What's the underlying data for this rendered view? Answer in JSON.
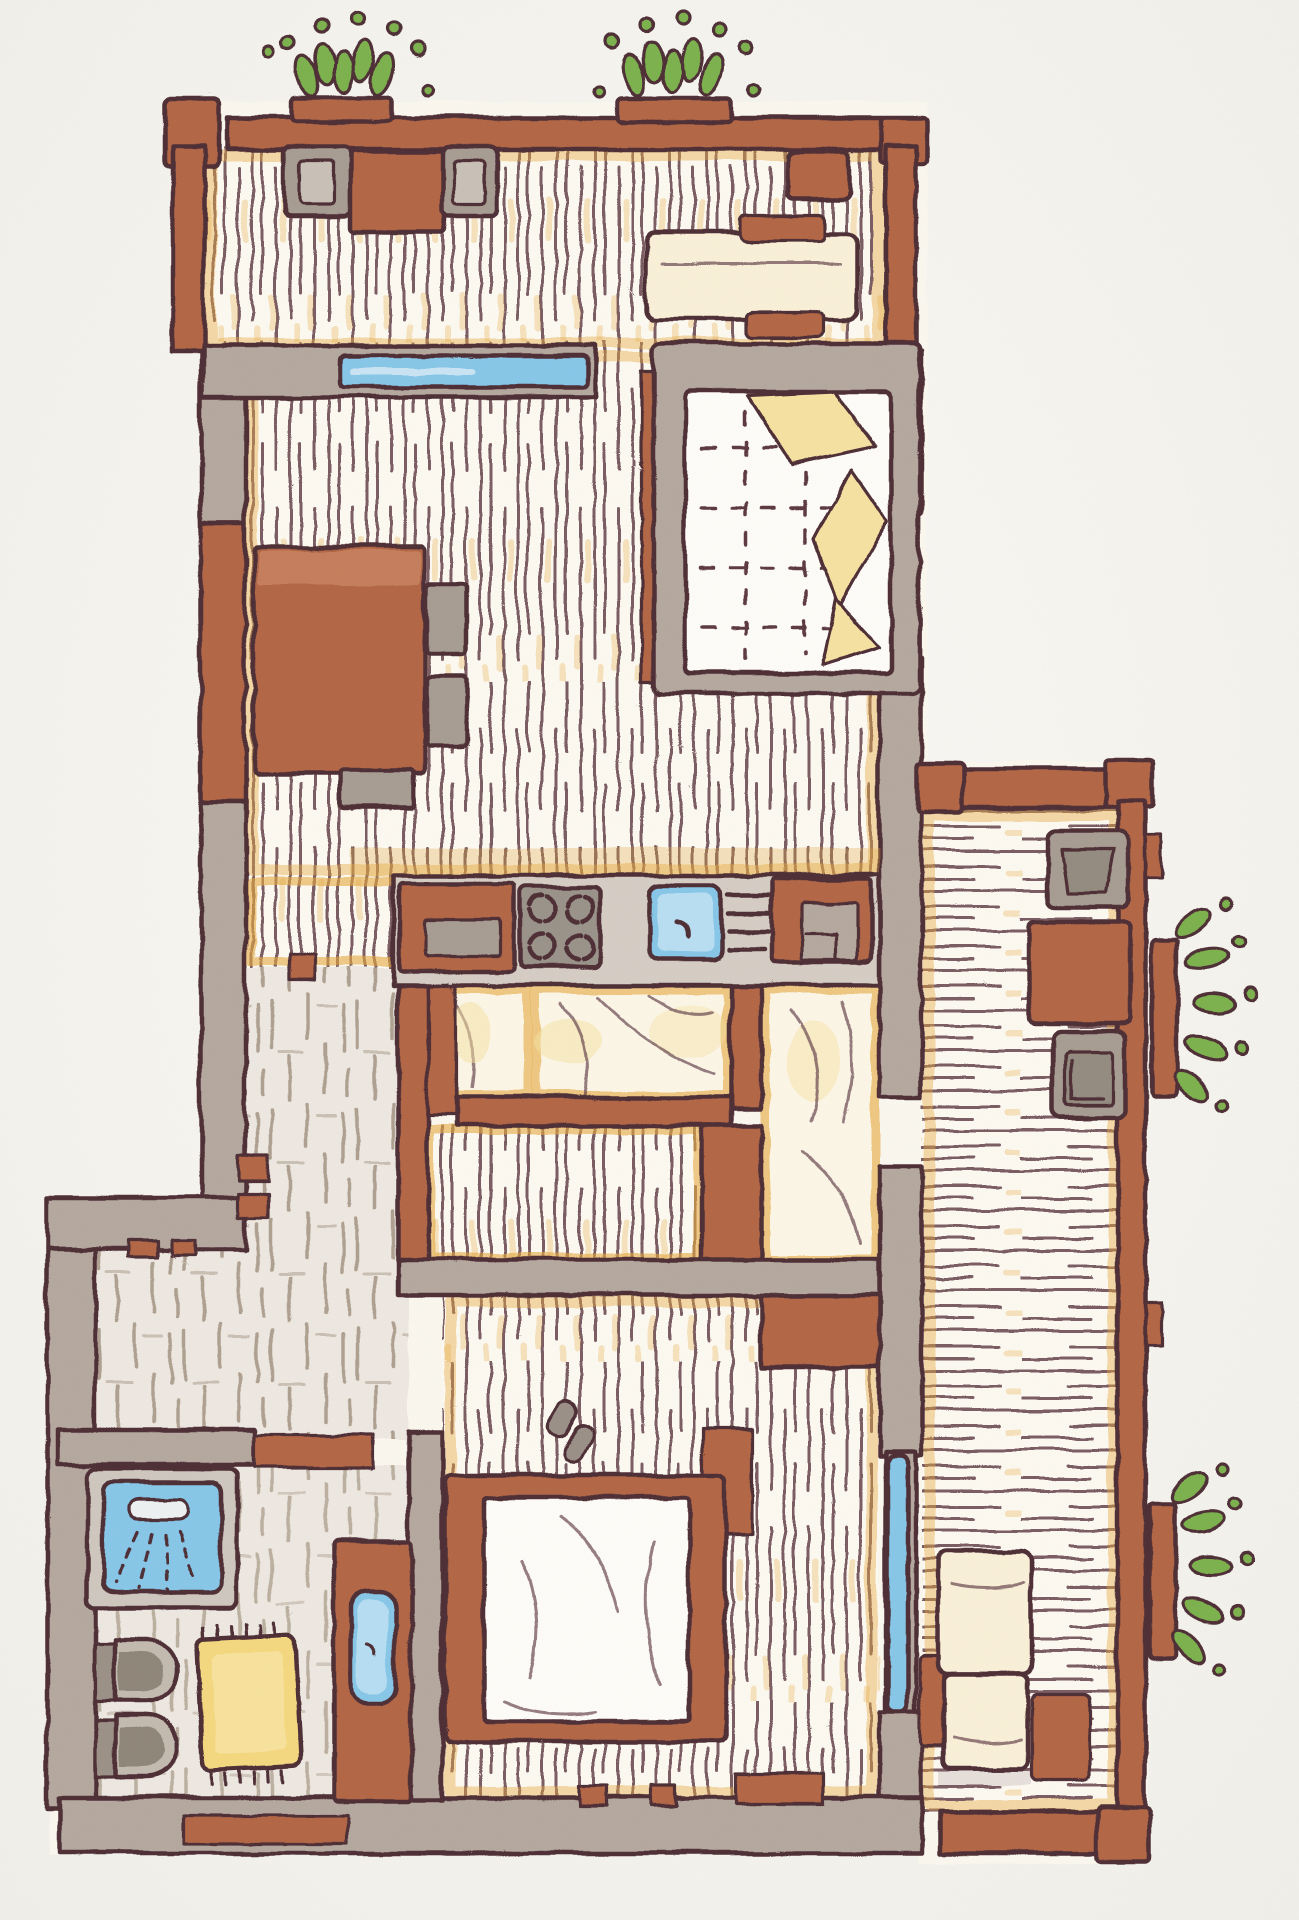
{
  "scene": {
    "type": "hand-drawn apartment floor plan, colored pencil on paper",
    "view": "top-down",
    "text_content": "none (drawing only, no labels or numbers visible)"
  },
  "palette": {
    "paper": "#f8f7f3",
    "outline": "#4e2d36",
    "wall_gray": "#b5a99f",
    "wall_gray_dark": "#a89c92",
    "counter_gray": "#d6cec5",
    "item_gray": "#a79d92",
    "item_gray_light": "#c9c1b7",
    "wall_red": "#b36644",
    "wall_red_light": "#c8835f",
    "wood": "#fdfaf2",
    "plank_line": "#59343e",
    "ochre": "#e6a93e",
    "blanket_yellow": "#f6e3a2",
    "rug_yellow": "#f5d97f",
    "window_blue": "#87c7e9",
    "window_blue_light": "#c5e5f5",
    "leaf_green": "#7cb24e",
    "tile_bg": "#eee9e2",
    "tile_line": "#94836f",
    "futon_bg": "#fdf7e8",
    "bench_cream": "#faf1d9",
    "mattress_white": "#fefdf9",
    "quilt_line": "#5c3842"
  },
  "building": {
    "areas": [
      {
        "name": "roof-terrace",
        "floor": "pale vertical wood planks",
        "items": [
          "gray chair",
          "terracotta side table",
          "gray chair",
          "terracotta armchair",
          "cream daybed",
          "two terracotta cushions"
        ],
        "plants": [
          "window box with green leaves (left)",
          "window box with green leaves (right)"
        ]
      },
      {
        "name": "living-sleeping-room",
        "floor": "pale vertical wood planks",
        "windows": [
          "wide blue window to terrace",
          "tall blue window in right wall"
        ],
        "items": [
          "double bed: gray frame, white quilted duvet with stitch dashes, yellow folded blankets",
          "terracotta wall pillar",
          "terracotta dining table",
          "two gray side chairs",
          "one gray end chair"
        ]
      },
      {
        "name": "kitchen",
        "items": [
          "terracotta base cabinet with gray handle",
          "gray hob with four burners",
          "blue sink with faucet",
          "dish drying rack",
          "terracotta tall cabinet with gray appliance"
        ]
      },
      {
        "name": "tatami-room-small",
        "floor": "soft cream futon texture with ochre border"
      },
      {
        "name": "tatami-room-large",
        "floor": "soft cream futon texture with ochre border"
      },
      {
        "name": "tatami-room-east",
        "floor": "soft cream futon texture with ochre border"
      },
      {
        "name": "dressing-room",
        "floor": "pale vertical wood planks",
        "items": [
          "pair of slippers"
        ]
      },
      {
        "name": "hallway-entry",
        "floor": "gray-brown stone tiles",
        "items": [
          "entry door jambs",
          "interior door jambs"
        ]
      },
      {
        "name": "bathroom",
        "items": [
          "shower with blue tray and shower head spray",
          "two gray toilets",
          "yellow fringed bath mat",
          "terracotta washstand with blue basin"
        ]
      },
      {
        "name": "bedroom",
        "floor": "pale vertical wood planks",
        "windows": [
          "tall blue window to east loggia"
        ],
        "items": [
          "double bed: terracotta frame, white duvet"
        ]
      },
      {
        "name": "east-loggia",
        "floor": "cream horizontal wood planks",
        "items": [
          "gray chair",
          "terracotta table",
          "gray chair",
          "cream lounge chair with terracotta side pads"
        ],
        "plants": [
          "hanging planter with green leaves (upper)",
          "hanging planter with green leaves (lower)"
        ]
      }
    ]
  }
}
